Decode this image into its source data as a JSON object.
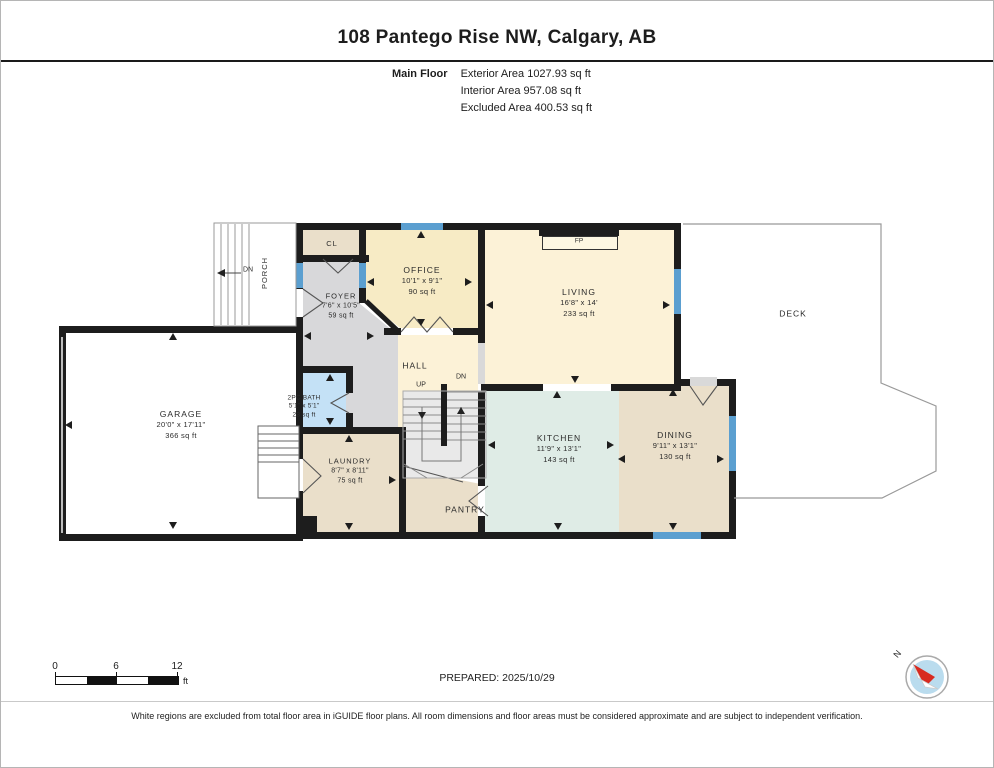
{
  "header": {
    "title": "108 Pantego Rise NW, Calgary, AB",
    "floor_label": "Main Floor",
    "stats": [
      "Exterior Area 1027.93 sq ft",
      "Interior Area 957.08 sq ft",
      "Excluded Area 400.53 sq ft"
    ]
  },
  "rooms": {
    "garage": {
      "name": "GARAGE",
      "dims": "20'0\" x 17'11\"",
      "area": "366 sq ft"
    },
    "foyer": {
      "name": "FOYER",
      "dims": "7'6\" x 10'5\"",
      "area": "59 sq ft"
    },
    "office": {
      "name": "OFFICE",
      "dims": "10'1\" x 9'1\"",
      "area": "90 sq ft"
    },
    "living": {
      "name": "LIVING",
      "dims": "16'8\" x 14'",
      "area": "233 sq ft"
    },
    "kitchen": {
      "name": "KITCHEN",
      "dims": "11'9\" x 13'1\"",
      "area": "143 sq ft"
    },
    "dining": {
      "name": "DINING",
      "dims": "9'11\" x 13'1\"",
      "area": "130 sq ft"
    },
    "laundry": {
      "name": "LAUNDRY",
      "dims": "8'7\" x 8'11\"",
      "area": "75 sq ft"
    },
    "bath": {
      "name": "2PC BATH",
      "dims": "5'1\" x 5'1\"",
      "area": "23 sq ft"
    },
    "hall": {
      "name": "HALL"
    },
    "pantry": {
      "name": "PANTRY"
    },
    "closet": {
      "name": "CL"
    },
    "porch": {
      "name": "PORCH"
    },
    "deck": {
      "name": "DECK"
    }
  },
  "plan_labels": {
    "up": "UP",
    "dn": "DN",
    "porch_dn": "DN",
    "fireplace": "FP"
  },
  "footer": {
    "scale": {
      "tick0": "0",
      "tick1": "6",
      "tick2": "12",
      "unit": "ft"
    },
    "prepared": "PREPARED: 2025/10/29",
    "compass_north": "N",
    "disclaimer": "White regions are excluded from total floor area in iGUIDE floor plans. All room dimensions and floor areas must be considered approximate and are subject to independent verification."
  },
  "colors": {
    "wall": "#1d1d1d",
    "window": "#5b9fd0",
    "room_cream": "#fcf2d7",
    "room_office": "#f7ebc5",
    "room_tan": "#eadfca",
    "room_gray": "#d8d8da",
    "room_mint": "#dfece6",
    "room_bath_blue": "#c4e1f6",
    "stairs": "#e9e9e9",
    "deck_outline": "#999999"
  }
}
